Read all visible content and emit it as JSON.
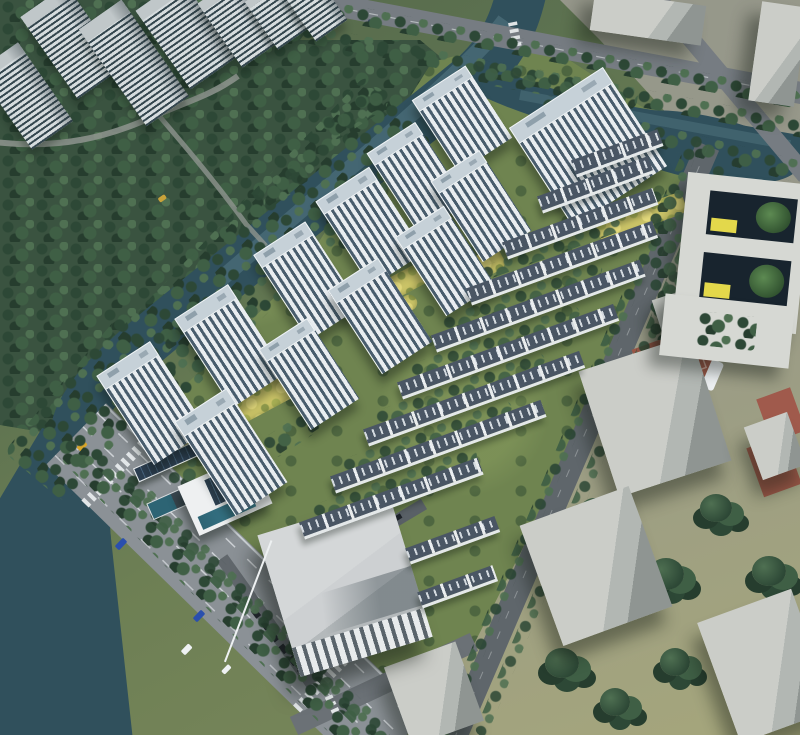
{
  "scene": {
    "title": "Aerial rendering of a riverside residential development master plan",
    "view": "aerial oblique bird's-eye, afternoon light, shadows falling to lower-left",
    "regions": {
      "top_left": "existing grey high-rise apartment towers surrounded by dense forest",
      "river": "dark teal canal winding from top center down the left side, with a branch and pond toward the top right",
      "development": "new white residential slab towers (left half) and rows of dark-roofed townhouses (right half) on landscaped green grounds",
      "boulevard": "wide tree-lined avenue running along the lower-left edge with lane markings, crosswalks and cars",
      "right_side": "grey massing blocks, a courtyard school building with yellow accents, and red sports courts on grey pavement",
      "bottom_center": "large light-grey community building with ridged roof, solar-panel clubhouse and parked cars",
      "bottom_right": "plain grey massing blocks on olive grass with tree groves and long shadows"
    },
    "counts": {
      "residential_towers": 13,
      "townhouse_rows": 10,
      "context_towers": 7,
      "context_blocks": 7,
      "basketball_courts": 3,
      "crosswalks": 3
    }
  },
  "palette": {
    "water": "#30505c",
    "waterLight": "#4a6e7c",
    "forestBase": "#3a5340",
    "treeDark": "#2d4836",
    "treeMid": "#3f5f45",
    "treeLight": "#4f7052",
    "treeDark2": "#263d2e",
    "grass": "#6f8450",
    "pave": "#95978b",
    "paveYellow": "#a5a67b",
    "road": "#767c82",
    "roadDark": "#5f666b",
    "boulevard": "#8b9196",
    "roadLine": "#d9dde0",
    "towerFacade": "#e9edf0",
    "towerWindow": "#495d6d",
    "towerRoof": "#c6d1d8",
    "ctxFacade": "#d6dcde",
    "ctxWindow": "#35474f",
    "thRoof": "#4a5664",
    "boxTop": "#cbcdc8",
    "boxSide": "#8f9592",
    "schoolWall": "#d6d8d3",
    "courtyardDark": "#18242e",
    "accentYellow": "#e3d84b",
    "stripYellow": "#cbc468",
    "courtRed": "#9a5747",
    "solar": "#32465a",
    "poolGlass": "#2d6474",
    "warehouseRoof": "#cdd0d2",
    "carBlue": "#2a4fae",
    "carWhite": "#eef1f3",
    "carYellow": "#d8a62a"
  }
}
